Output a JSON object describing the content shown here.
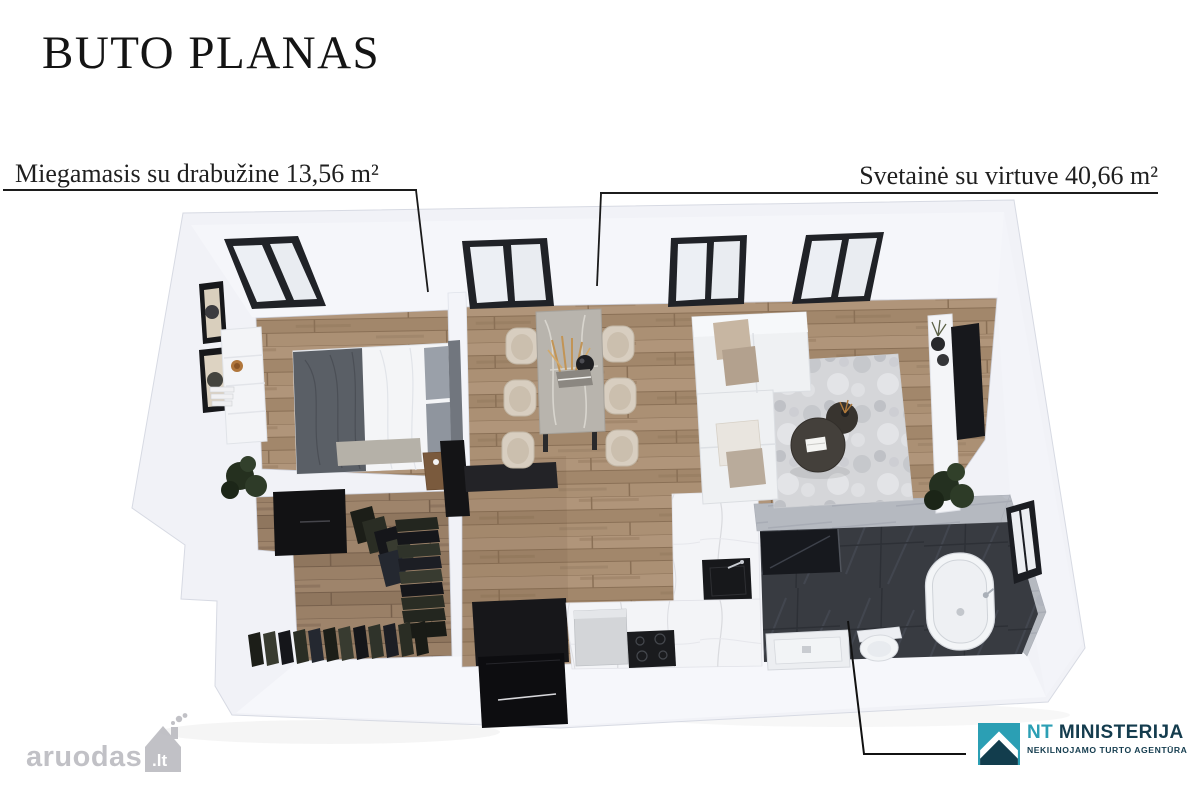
{
  "title": "BUTO PLANAS",
  "room_labels": {
    "bedroom": {
      "text": "Miegamasis su drabužine 13,56 m²",
      "name": "Miegamasis su drabužine",
      "area": "13,56 m²"
    },
    "living": {
      "text": "Svetainė su virtuve 40,66 m²",
      "name": "Svetainė su virtuve",
      "area": "40,66 m²"
    }
  },
  "watermark": {
    "text": "aruodas",
    "tld": ".lt",
    "icon": "house-chimney-icon",
    "color": "#b7b7bd"
  },
  "agency": {
    "icon": "mountain-roof-icon",
    "brand_accent": "NT",
    "brand_rest": "MINISTERIJA",
    "tagline": "NEKILNOJAMO TURTO AGENTŪRA",
    "accent_color": "#2b9fb4",
    "navy_color": "#143c4e"
  },
  "palette": {
    "background": "#ffffff",
    "wall": "#f1f2f7",
    "wood_floor": "#a98e72",
    "wood_floor_dark": "#977d64",
    "marble_floor": "#f3f4f6",
    "bathroom_floor": "#3a3d43",
    "bathroom_wall": "#b6bac1",
    "window_frame": "#202227",
    "leader_line": "#1a1a1a",
    "text": "#1f1f1f"
  }
}
